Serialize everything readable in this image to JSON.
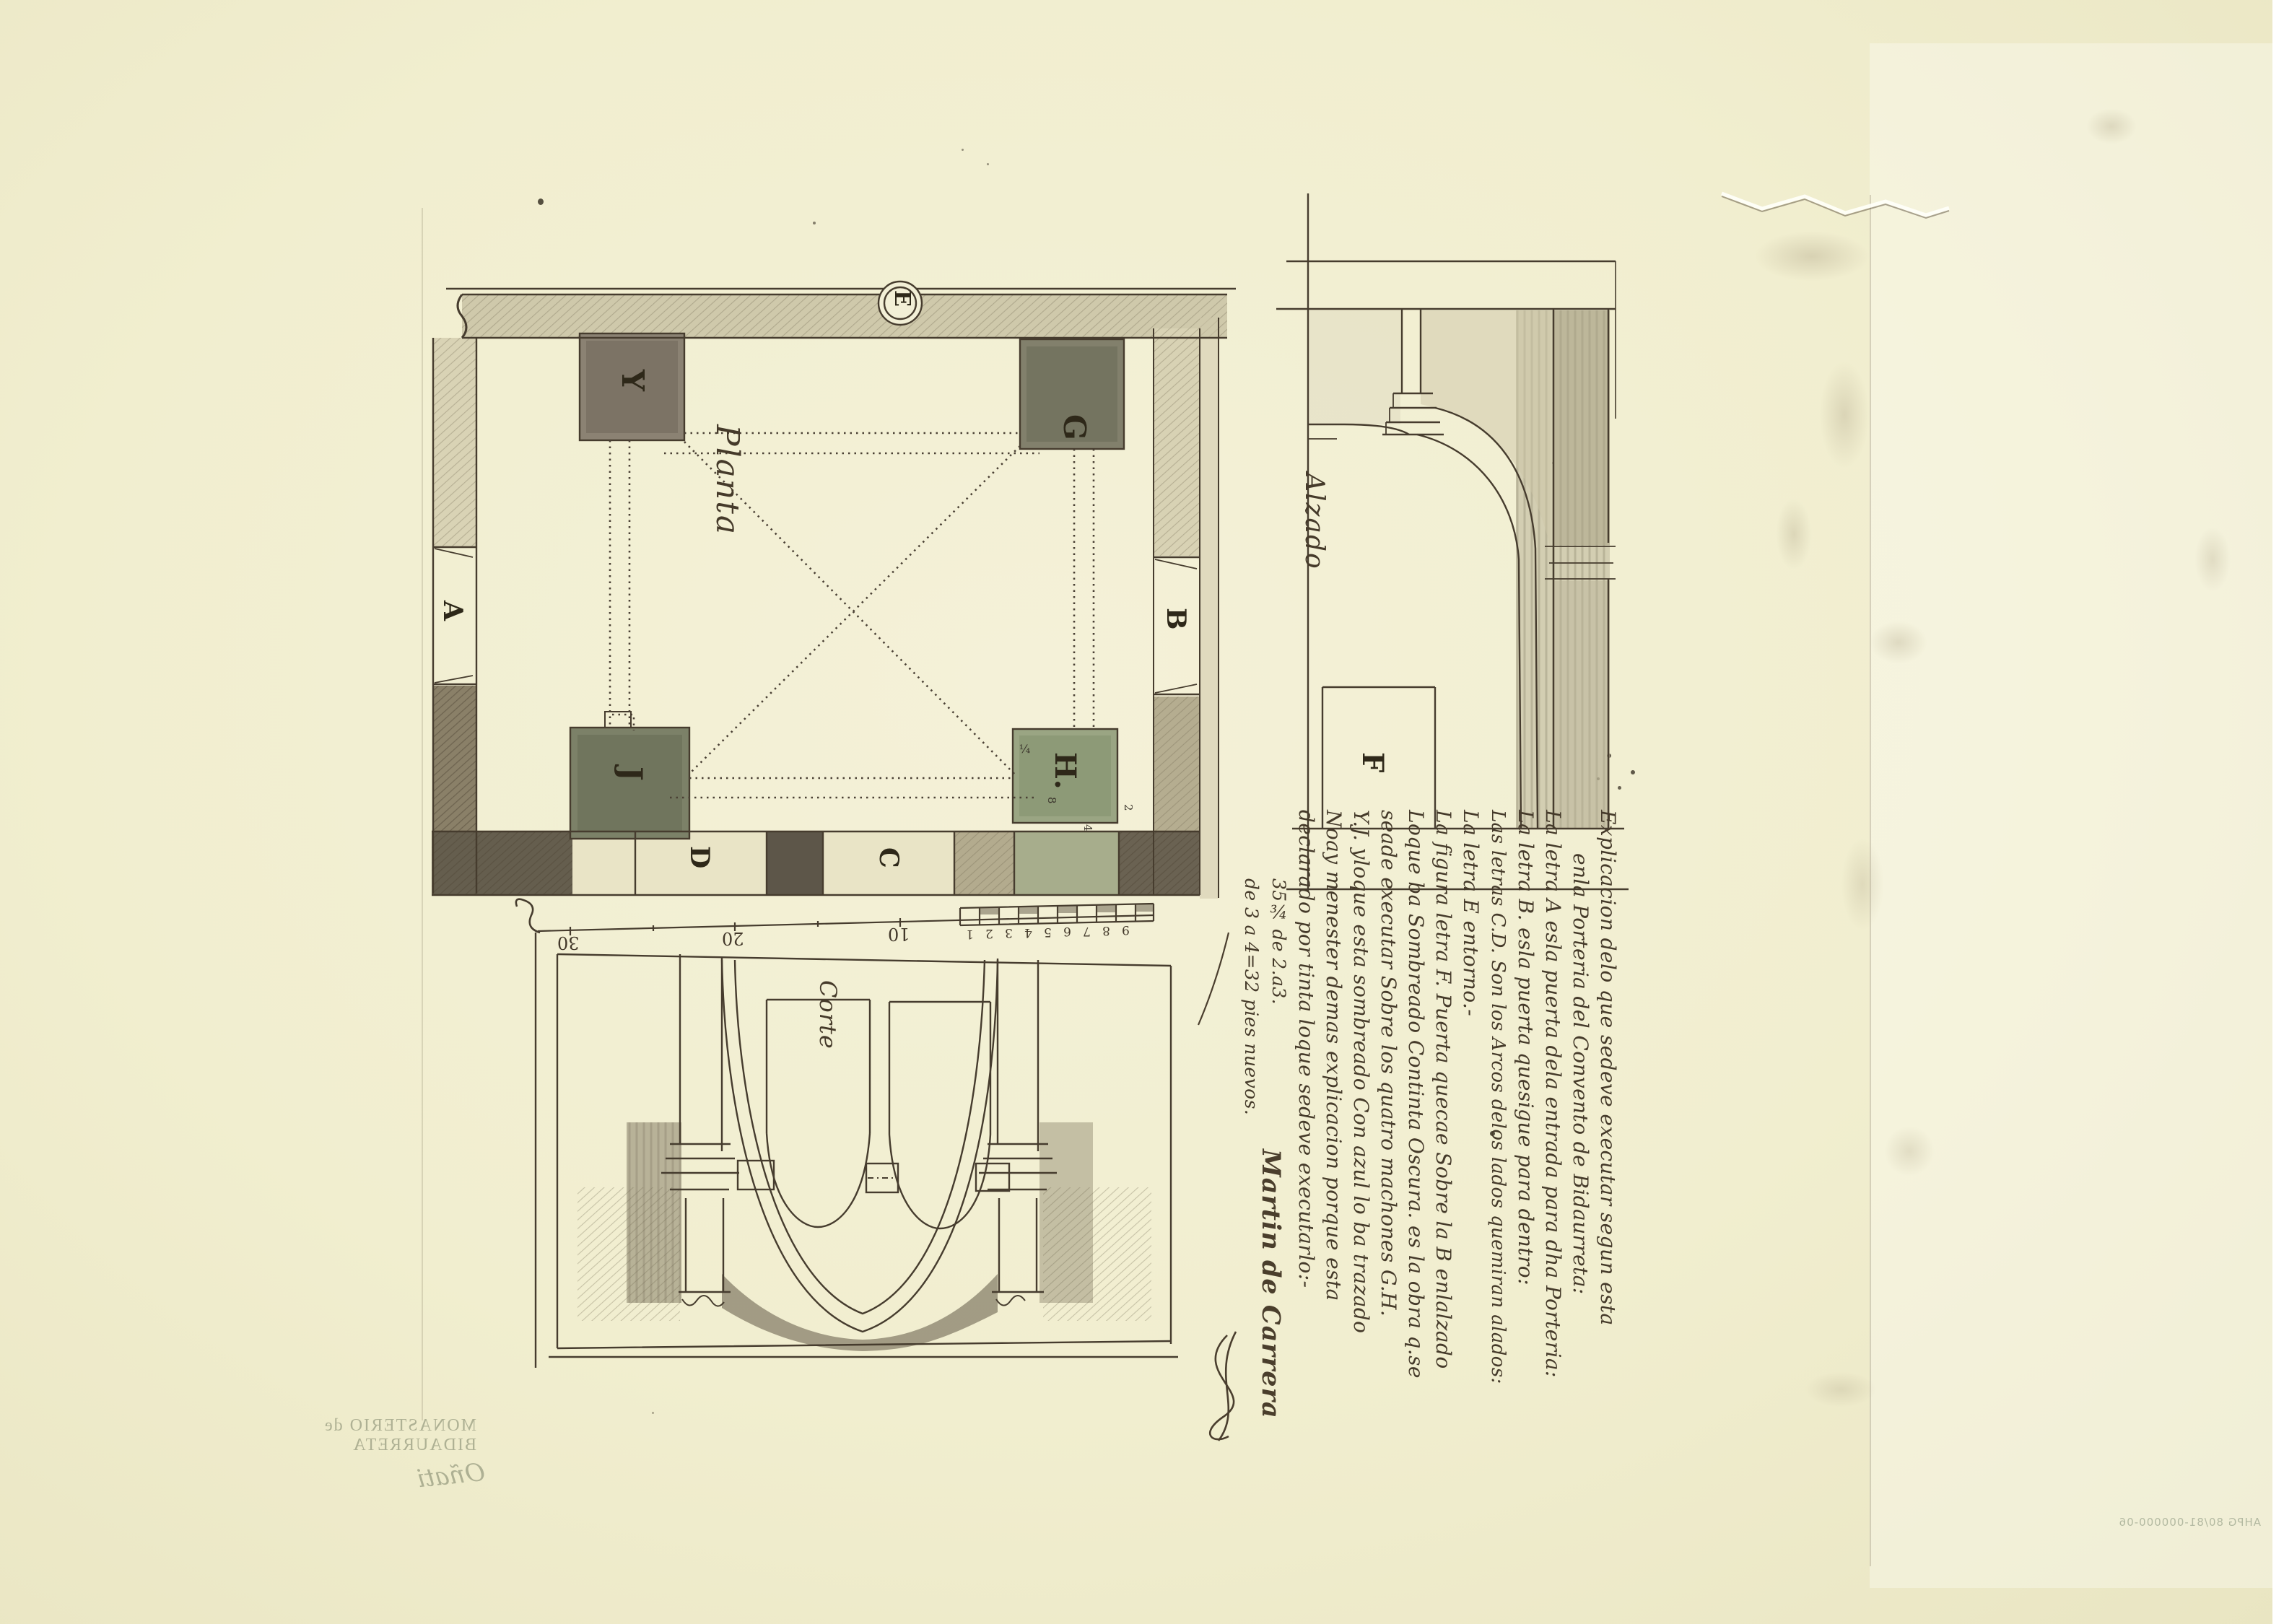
{
  "document": {
    "kind": "archival architectural drawing (manuscript, 18th c.)",
    "colors": {
      "paper": "#f1eecf",
      "ink": "#463c2e",
      "dark_wash": "#5d5649",
      "warm_wash": "#8b8273",
      "green_wash": "#9aa583",
      "light_wash": "#d6d0b2"
    }
  },
  "plan": {
    "label": "Planta",
    "letters": {
      "Y": "Y",
      "G": "G",
      "J": "J",
      "H": "H.",
      "A": "A",
      "B": "B",
      "C": "C",
      "D": "D",
      "E": "E"
    },
    "pier_marks": [
      "¼",
      "8",
      "2",
      "4"
    ]
  },
  "alzado": {
    "label": "Alzado",
    "letter_f": "F"
  },
  "corte": {
    "label": "Corte"
  },
  "scale_bar": {
    "numbers": [
      "30",
      "20",
      "10"
    ],
    "subdivisions": [
      "1",
      "2",
      "3",
      "4",
      "5",
      "6",
      "7",
      "8",
      "9"
    ]
  },
  "legend": {
    "lines": [
      "Explicacion delo que sedeve executar segun esta",
      "enla Porteria del Convento de Bidaurreta:",
      "La letra A esla puerta dela entrada para dha Porteria:",
      "La letra B. esla puerta quesigue para dentro:",
      "Las letras C.D. Son los Arcos delos lados quemiran alados:",
      "La letra E entorno.-",
      "La figura letra F. Puerta quecae Sobre la B enlalzado",
      "Loque ba Sombreado Continta Oscura. es la obra q.se",
      "seade executar Sobre los quatro machones G.H.",
      "Y.J. yloque esta sombreado Con azul lo ba trazado",
      "Noay menester demas explicacion porque esta",
      "declarado por tinta loque sedeve executarlo:-",
      "35¾ de 2.a3.",
      "de 3 a 4=32 pies nuevos."
    ],
    "signature": "Martin de Carrera"
  },
  "faint": {
    "verso_line1": "MONASTERIO de BIDAURRETA",
    "verso_line2": "Oñati",
    "stamp": "AHPG 80/81-000000-06"
  }
}
